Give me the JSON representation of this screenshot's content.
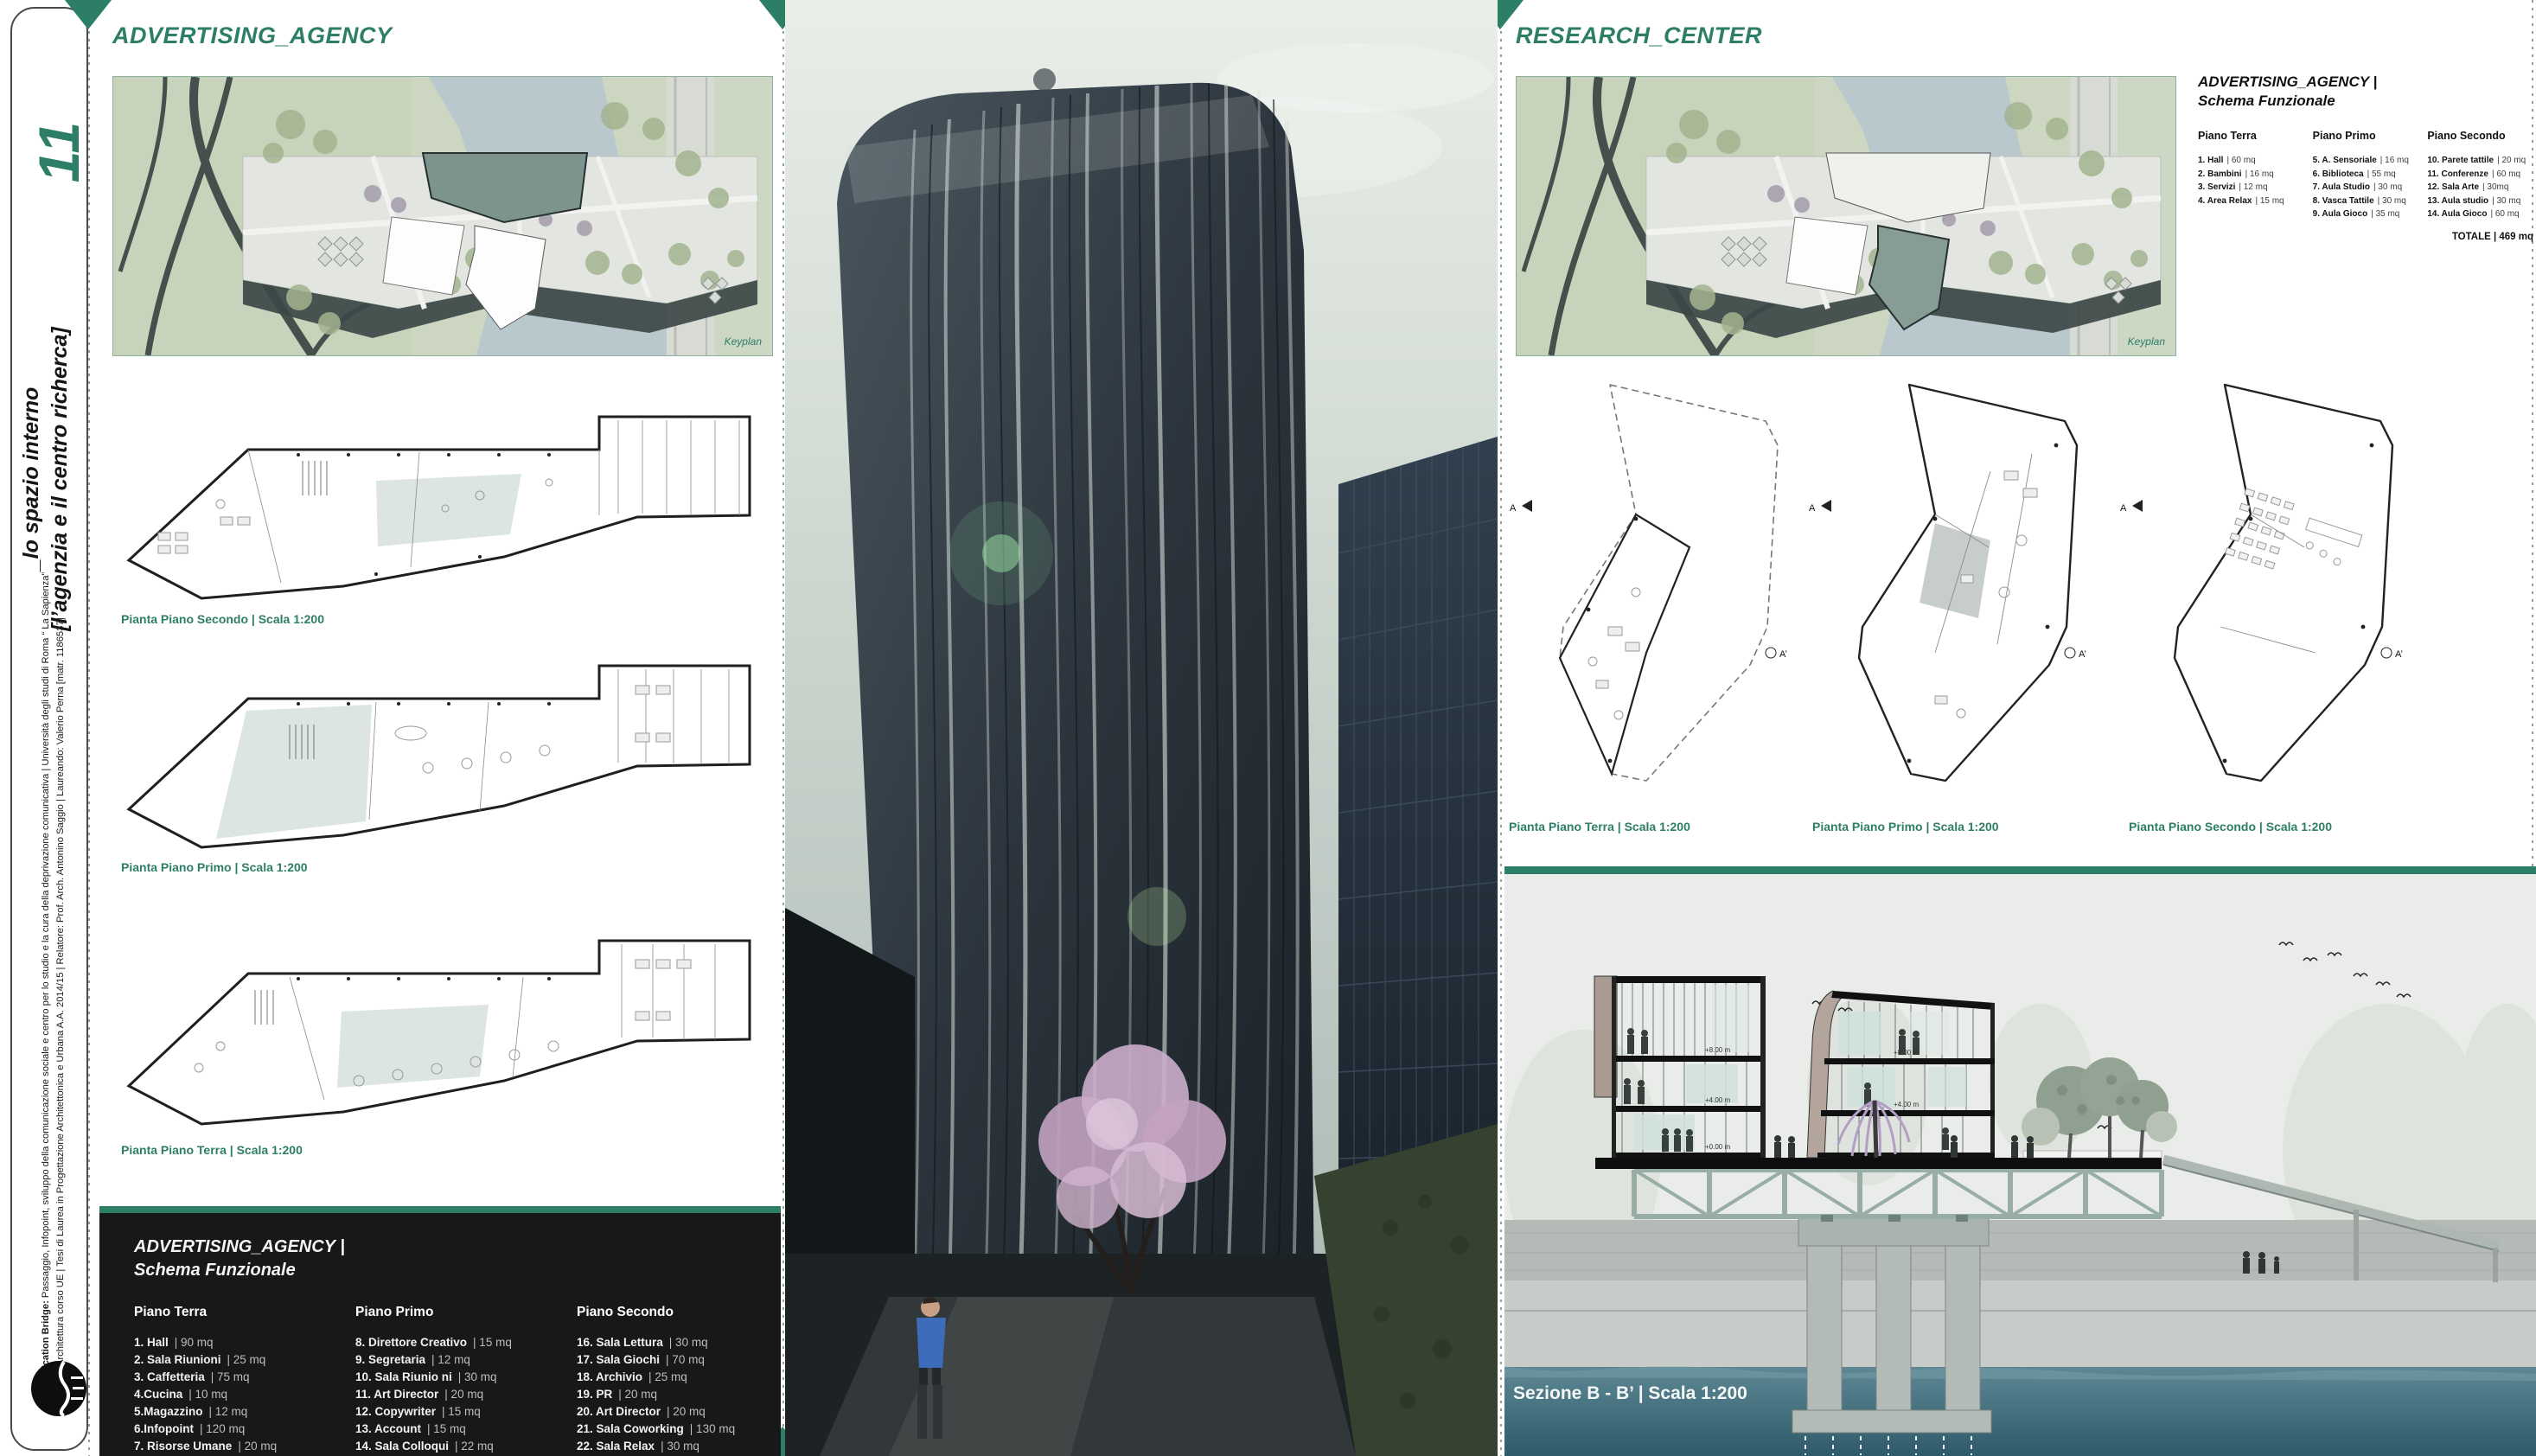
{
  "colors": {
    "accent": "#2d7e67",
    "box_bg": "#181818"
  },
  "sidebar": {
    "page_number": "11",
    "title_line1": "_lo spazio interno",
    "title_line2": "[l’agenzia e il centro richerca]",
    "credits_bold": "Communication Bridge:",
    "credits_line1": "Passaggio, Infopoint, sviluppo della comunicazione sociale  e centro per lo studio e la cura della deprivazione comunicativa | Università degli studi di Roma “ La Sapienza”",
    "credits_line2": "Facoltà di Architettura corso UE | Tesi di Laurea in Progettazione Architettonica e Urbana A.A. 2014/15 | Relatore: Prof. Arch. Antonino Saggio | Laureando: Valerio Perna [matr. 1186537]"
  },
  "left": {
    "title": "ADVERTISING_AGENCY",
    "keyplan_label": "Keyplan",
    "plan_labels": [
      "Pianta Piano Secondo | Scala 1:200",
      "Pianta Piano Primo | Scala 1:200",
      "Pianta Piano Terra | Scala 1:200"
    ],
    "schema": {
      "title_line1": "ADVERTISING_AGENCY |",
      "title_line2": "Schema Funzionale",
      "col1": {
        "heading": "Piano Terra",
        "items": [
          {
            "n": "1. Hall",
            "a": "|  90  mq"
          },
          {
            "n": "2. Sala Riunioni",
            "a": "| 25 mq"
          },
          {
            "n": "3. Caffetteria",
            "a": "| 75 mq"
          },
          {
            "n": "4.Cucina",
            "a": "| 10 mq"
          },
          {
            "n": "5.Magazzino",
            "a": "| 12 mq"
          },
          {
            "n": "6.Infopoint",
            "a": "| 120 mq"
          },
          {
            "n": "7. Risorse Umane",
            "a": "|  20 mq"
          },
          {
            "n": "                         ",
            "a": "|  15 mq"
          }
        ]
      },
      "col2": {
        "heading": "Piano Primo",
        "items": [
          {
            "n": "8. Direttore Creativo",
            "a": "|  15 mq"
          },
          {
            "n": "9. Segretaria",
            "a": "|  12 mq"
          },
          {
            "n": "10. Sala Riunio ni",
            "a": "|  30 mq"
          },
          {
            "n": "11. Art Director",
            "a": "|  20 mq"
          },
          {
            "n": "12. Copywriter",
            "a": "|  15 mq"
          },
          {
            "n": "13. Account",
            "a": "| 15 mq"
          },
          {
            "n": "14. Sala Colloqui",
            "a": "| 22 mq"
          },
          {
            "n": "15. Sala Lettura",
            "a": "|  70 mq"
          }
        ]
      },
      "col3": {
        "heading": "Piano Secondo",
        "items": [
          {
            "n": "16. Sala Lettura",
            "a": "|  30 mq"
          },
          {
            "n": "17. Sala Giochi",
            "a": "|  70 mq"
          },
          {
            "n": "18. Archivio",
            "a": "|  25 mq"
          },
          {
            "n": "19. PR",
            "a": "| 20 mq"
          },
          {
            "n": "20. Art Director",
            "a": "|  20 mq"
          },
          {
            "n": "21. Sala Coworking",
            "a": "| 130 mq"
          },
          {
            "n": "22. Sala Relax",
            "a": "| 30 mq"
          }
        ],
        "total": "TOTALE  |   900 mq"
      }
    }
  },
  "right": {
    "title": "RESEARCH_CENTER",
    "keyplan_label": "Keyplan",
    "schema": {
      "title_line1": "ADVERTISING_AGENCY |",
      "title_line2": "Schema Funzionale",
      "col1": {
        "heading": "Piano Terra",
        "items": [
          {
            "n": "1. Hall",
            "a": "| 60 mq"
          },
          {
            "n": "2. Bambini",
            "a": "| 16 mq"
          },
          {
            "n": "3. Servizi",
            "a": "| 12 mq"
          },
          {
            "n": "4. Area Relax",
            "a": "| 15 mq"
          }
        ]
      },
      "col2": {
        "heading": "Piano Primo",
        "items": [
          {
            "n": "5. A. Sensoriale",
            "a": "| 16 mq"
          },
          {
            "n": "6. Biblioteca",
            "a": "| 55 mq"
          },
          {
            "n": "7. Aula Studio",
            "a": "| 30 mq"
          },
          {
            "n": "8. Vasca Tattile",
            "a": "| 30 mq"
          },
          {
            "n": "9. Aula Gioco",
            "a": "| 35 mq"
          }
        ]
      },
      "col3": {
        "heading": "Piano  Secondo",
        "items": [
          {
            "n": "10. Parete tattile",
            "a": "| 20 mq"
          },
          {
            "n": "11. Conferenze",
            "a": "| 60 mq"
          },
          {
            "n": "12. Sala Arte",
            "a": "| 30mq"
          },
          {
            "n": "13. Aula studio",
            "a": "| 30 mq"
          },
          {
            "n": "14. Aula Gioco",
            "a": "| 60 mq"
          }
        ],
        "total": "TOTALE | 469 mq"
      }
    },
    "plan_labels": [
      "Pianta Piano Terra | Scala 1:200",
      "Pianta Piano Primo | Scala 1:200",
      "Pianta Piano Secondo | Scala 1:200"
    ],
    "plan_marker_a": "A",
    "plan_marker_a2": "A’"
  },
  "section": {
    "label": "Sezione B - B’ | Scala 1:200",
    "levels": [
      "+8.00 m",
      "+4.00 m",
      "+0.00 m"
    ]
  }
}
